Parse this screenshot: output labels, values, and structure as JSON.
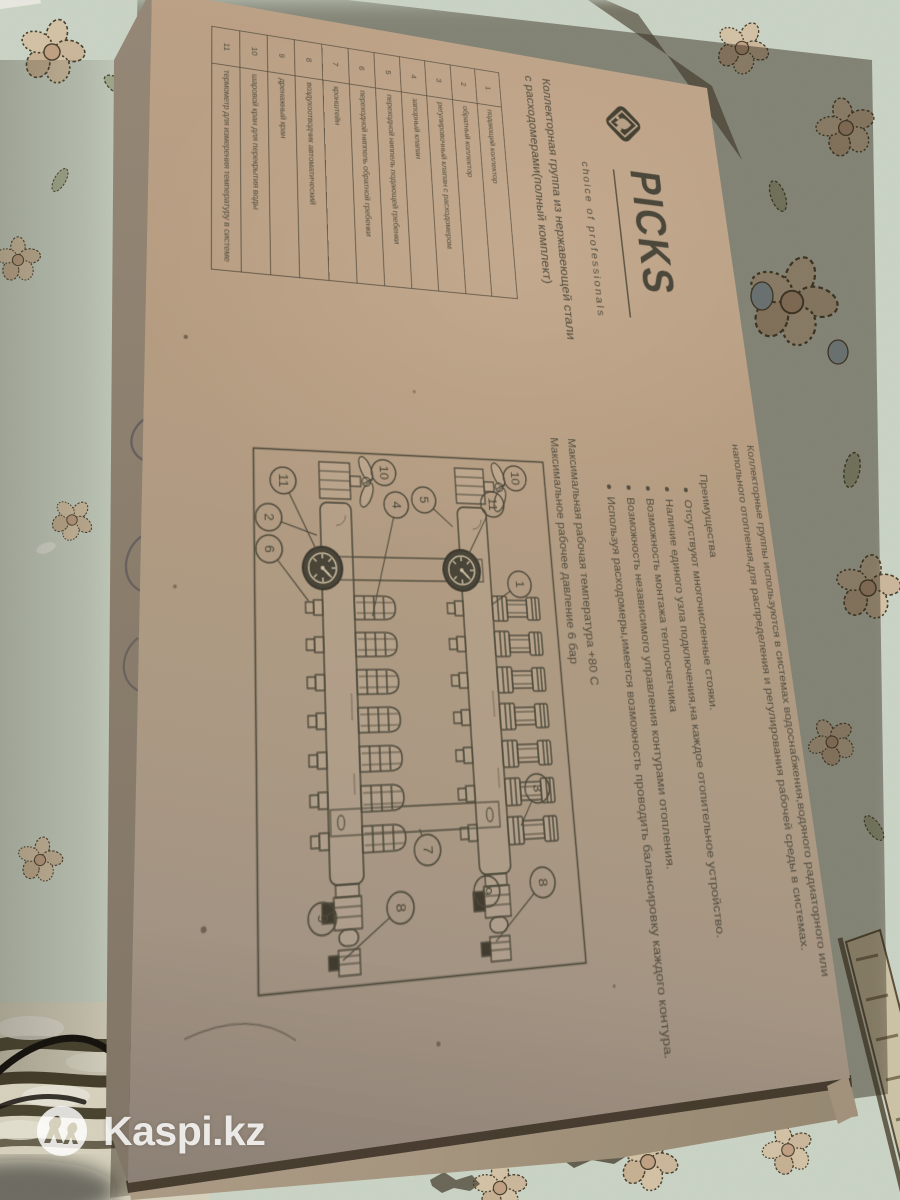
{
  "watermark": {
    "text": "Kaspi.kz",
    "icon": "kaspi-logo-icon"
  },
  "box": {
    "brand": {
      "name": "PICKS",
      "tagline": "choice of professionals",
      "icon": "picks-diamond-icon"
    },
    "product_title_lines": [
      "Коллекторная группа из нержавеющей стали",
      "с расходомерами(полный комплект)"
    ],
    "parts_table": {
      "rows": [
        {
          "num": "1",
          "name": "подающий коллектор"
        },
        {
          "num": "2",
          "name": "обратный коллектор"
        },
        {
          "num": "3",
          "name": "регулировочный клапан с расходомером"
        },
        {
          "num": "4",
          "name": "запорный клапан"
        },
        {
          "num": "5",
          "name": "переходной ниппель подающей гребенки"
        },
        {
          "num": "6",
          "name": "переходной ниппель обратной гребенки"
        },
        {
          "num": "7",
          "name": "кронштейн"
        },
        {
          "num": "8",
          "name": "воздухоотводчик автоматический"
        },
        {
          "num": "9",
          "name": "дренажный кран"
        },
        {
          "num": "10",
          "name": "шаровой кран для перекрытия воды"
        },
        {
          "num": "11",
          "name": "термометр для измерения температуру в системе"
        }
      ]
    },
    "description": {
      "intro_lines": [
        "Коллекторные группы используются в системах водоснабжения,водяного радиаторного или",
        "напольного отопления,для распределения и регулирования рабочей среды в системах."
      ],
      "advantages_heading": "Преимущества",
      "advantages": [
        "Отсутствуют многочисленные стояки.",
        "Наличие единого узла подключения,на каждое отопительное устройство.",
        "Возможность монтажа теплосчетчика",
        "Возможность независимого управления контурами отопления.",
        "Используя расходомеры,имеется возможность проводить балансировку каждого контура."
      ],
      "specs": [
        "Максимальная рабочая температура +80 С",
        "Максимальное рабочее давление 6 бар"
      ]
    },
    "diagram": {
      "outlet_count": 7,
      "callouts": [
        {
          "n": "10",
          "x": 20,
          "y": 36,
          "tx": 32,
          "ty": 58
        },
        {
          "n": "11",
          "x": 48,
          "y": 64,
          "tx": 102,
          "ty": 96
        },
        {
          "n": "1",
          "x": 128,
          "y": 40,
          "tx": 148,
          "ty": 72
        },
        {
          "n": "5",
          "x": 46,
          "y": 140,
          "tx": 72,
          "ty": 110
        },
        {
          "n": "4",
          "x": 52,
          "y": 170,
          "tx": 160,
          "ty": 200
        },
        {
          "n": "10",
          "x": 20,
          "y": 182,
          "tx": 32,
          "ty": 204
        },
        {
          "n": "11",
          "x": 32,
          "y": 287,
          "tx": 100,
          "ty": 254
        },
        {
          "n": "2",
          "x": 68,
          "y": 302,
          "tx": 84,
          "ty": 254
        },
        {
          "n": "6",
          "x": 98,
          "y": 302,
          "tx": 146,
          "ty": 264
        },
        {
          "n": "3",
          "x": 320,
          "y": 38,
          "tx": 352,
          "ty": 58
        },
        {
          "n": "7",
          "x": 368,
          "y": 155,
          "tx": 350,
          "ty": 162
        },
        {
          "n": "8",
          "x": 402,
          "y": 40,
          "tx": 448,
          "ty": 92
        },
        {
          "n": "9",
          "x": 406,
          "y": 98,
          "tx": 416,
          "ty": 108
        },
        {
          "n": "8",
          "x": 414,
          "y": 184,
          "tx": 452,
          "ty": 240
        },
        {
          "n": "9",
          "x": 418,
          "y": 258,
          "tx": 416,
          "ty": 254
        }
      ]
    }
  },
  "colors": {
    "cardboard": "#b49c81",
    "ink": "#4b473a",
    "carpet_field": "#ccd6c8",
    "carpet_stripe": "#46412c",
    "watermark_white": "#ffffff"
  }
}
